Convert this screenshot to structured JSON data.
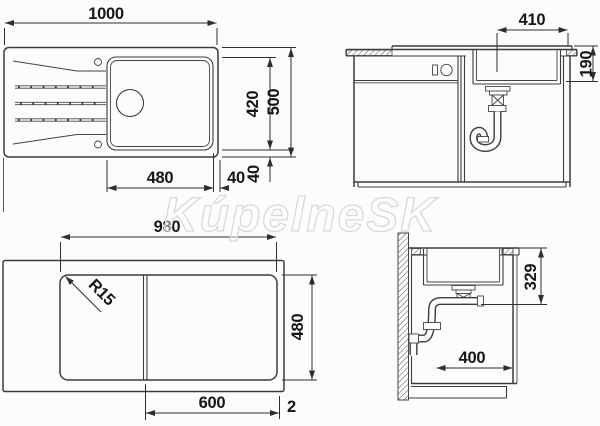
{
  "watermark": "KúpelneSK",
  "colors": {
    "line": "#3c3c3c",
    "text": "#161616",
    "background": "#fcfcfc",
    "watermark": "#d9d9d9"
  },
  "drawing": {
    "top_view": {
      "overall_width": "1000",
      "bowl_depth": "420",
      "overall_depth": "500",
      "bowl_width": "480",
      "rim_right": "40",
      "rim_bottom": "40"
    },
    "front_view": {
      "cutout_width": "410",
      "bowl_height": "190"
    },
    "bottom_view": {
      "base_width": "980",
      "base_depth": "480",
      "board_width": "600",
      "edge_offset": "2",
      "corner_radius": "R15"
    },
    "side_view": {
      "drain_height": "329",
      "drain_offset": "400"
    }
  }
}
